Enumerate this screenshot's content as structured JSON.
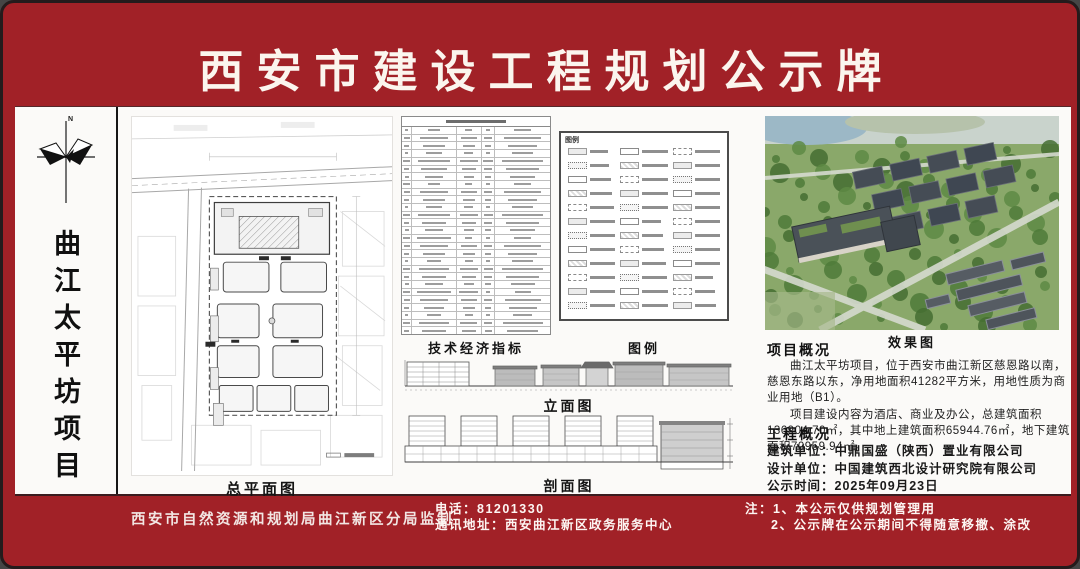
{
  "board": {
    "title": "西安市建设工程规划公示牌",
    "colors": {
      "board_red": "#a12127",
      "panel_white": "#fbfaf8",
      "ink": "#141414",
      "title_text": "#fbf5ee"
    }
  },
  "sidebar": {
    "project_name": "曲江太平坊项目",
    "compass_icon": "compass-north-icon",
    "north_label": "N"
  },
  "sections": {
    "site_plan_label": "总平面图",
    "indicators_label": "技术经济指标",
    "legend_label": "图例",
    "legend_inner_title": "图例",
    "elevation_label": "立面图",
    "section_label": "剖面图",
    "rendering_label": "效果图"
  },
  "project_overview": {
    "heading": "项目概况",
    "para1": "曲江太平坊项目，位于西安市曲江新区慈恩路以南，慈恩东路以东，净用地面积41282平方米，用地性质为商业用地（B1）。",
    "para2": "项目建设内容为酒店、商业及办公，总建筑面积136904.70㎡，其中地上建筑面积65944.76㎡，地下建筑面积70959.94㎡。"
  },
  "engineering_overview": {
    "heading": "工程概况",
    "builder": "建筑单位：中鼎国盛（陕西）置业有限公司",
    "designer": "设计单位：中国建筑西北设计研究院有限公司",
    "publish_date": "公示时间：2025年09月23日"
  },
  "footer": {
    "supervisor": "西安市自然资源和规划局曲江新区分局监制",
    "phone": "电话：81201330",
    "address": "通讯地址：西安曲江新区政务服务中心",
    "note1": "注：1、本公示仅供规划管理用",
    "note2": "2、公示牌在公示期间不得随意移撤、涂改"
  },
  "decor": {
    "table_rows": 27,
    "legend_rows": 12,
    "legend_cols": 3
  }
}
